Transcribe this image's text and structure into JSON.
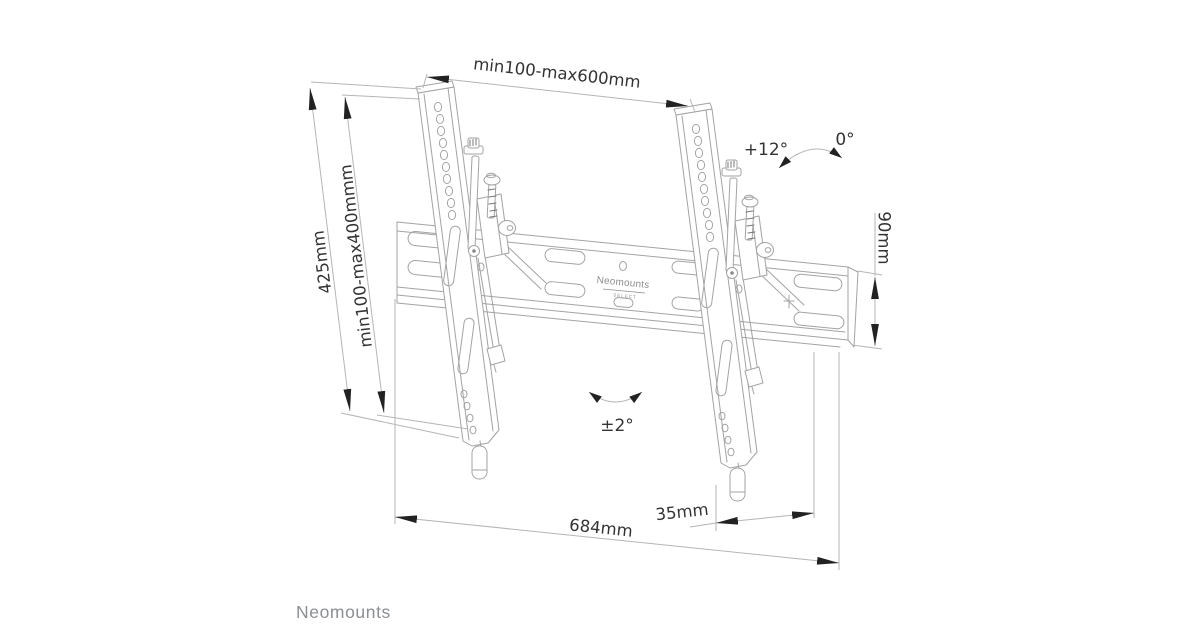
{
  "diagram": {
    "type": "technical-dimension-drawing",
    "subject": "tilting TV wall mount",
    "dimensions": {
      "top_width": "min100-max600mm",
      "bracket_height": "425mm",
      "vesa_height": "min100-max400mmm",
      "rail_height": "90mm",
      "total_width": "684mm",
      "wall_depth": "35mm"
    },
    "angles": {
      "tilt_max": "+12°",
      "tilt_zero": "0°",
      "level_correction": "±2°"
    },
    "plate_logo": {
      "brand": "Neomounts",
      "series": "SELECT"
    }
  },
  "footer": {
    "brand": "Neomounts"
  },
  "colors": {
    "background": "#ffffff",
    "outline": "#a3a3a3",
    "dimension_line": "#b5b5b5",
    "arrowhead": "#222222",
    "dimension_text": "#333333",
    "footer_text": "#8b8f92",
    "plate_logo_text": "#8f8f8f"
  }
}
